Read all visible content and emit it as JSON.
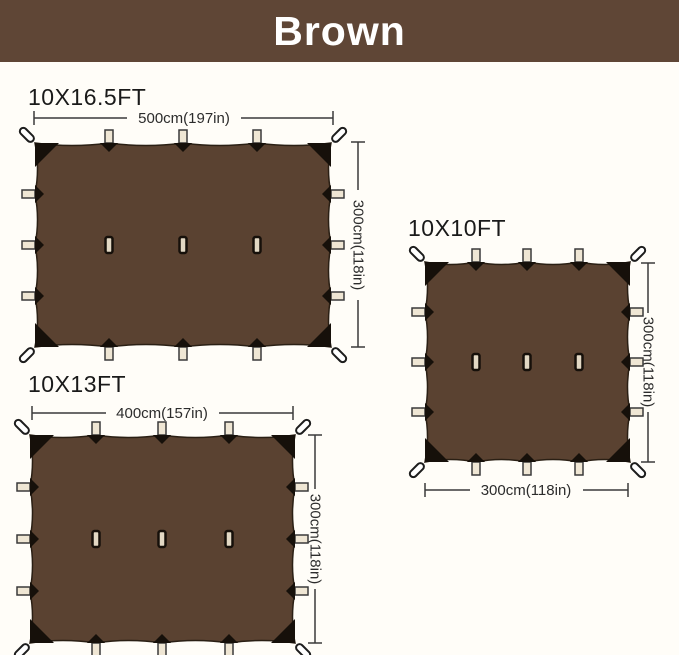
{
  "header": {
    "title": "Brown"
  },
  "colors": {
    "banner_bg": "#5f4636",
    "banner_text": "#ffffff",
    "tarp_fill": "#5a4231",
    "corner_patch": "#16100a",
    "tab_fill": "#efe6d4",
    "slot_fill": "#e2d8c4",
    "loop_fill": "#ffffff",
    "dimension_line": "#3a3a3a",
    "background": "#fffdf8"
  },
  "tarps": [
    {
      "title": "10X16.5FT",
      "width_label": "500cm(197in)",
      "height_label": "300cm(118in)"
    },
    {
      "title": "10X10FT",
      "width_label": "300cm(118in)",
      "height_label": "300cm(118in)"
    },
    {
      "title": "10X13FT",
      "width_label": "400cm(157in)",
      "height_label": "300cm(118in)"
    }
  ]
}
